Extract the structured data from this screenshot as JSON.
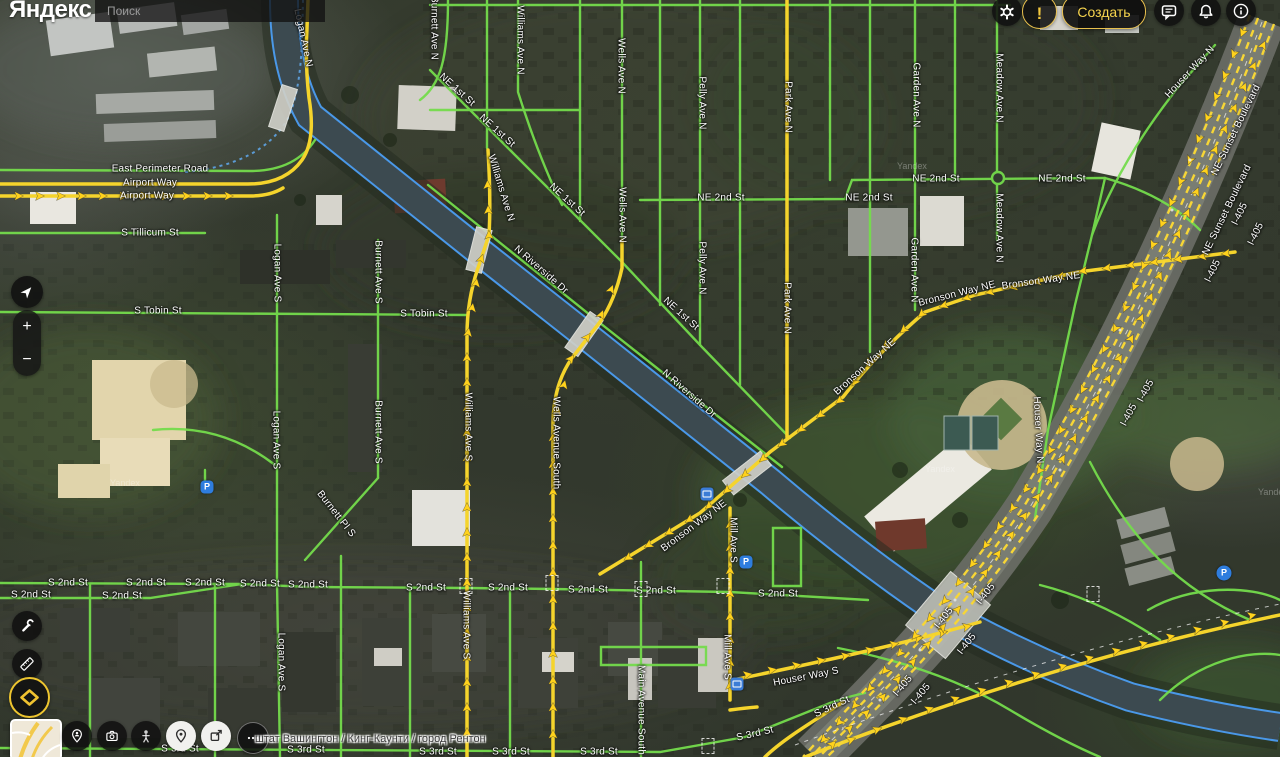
{
  "header": {
    "logo": "Яндекс",
    "search_placeholder": "Поиск",
    "create_label": "Создать",
    "icons": [
      "gear-icon",
      "alert-icon",
      "chat-icon",
      "bell-icon",
      "info-icon"
    ]
  },
  "controls": {
    "zoom_in": "+",
    "zoom_out": "−",
    "icons": [
      "compass-icon",
      "wrench-icon",
      "ruler-icon",
      "layers-diamond-icon",
      "person-pin-icon",
      "camera-icon",
      "pegman-icon",
      "map-pin-icon",
      "external-link-icon",
      "more-icon"
    ]
  },
  "footer": {
    "breadcrumb": "штат Вашингтон / Кинг-Каунти / город Рентон"
  },
  "map": {
    "watermark_text": "Yandex",
    "watermarks": [
      {
        "x": 110,
        "y": 478
      },
      {
        "x": 925,
        "y": 464
      },
      {
        "x": 897,
        "y": 161
      },
      {
        "x": 1258,
        "y": 487
      }
    ],
    "poi": [
      {
        "k": "parking",
        "x": 207,
        "y": 487,
        "label": "P"
      },
      {
        "k": "parking",
        "x": 746,
        "y": 562,
        "label": "P"
      },
      {
        "k": "parking-round",
        "x": 1224,
        "y": 573,
        "label": "P"
      },
      {
        "k": "bus",
        "x": 707,
        "y": 494
      },
      {
        "k": "train",
        "x": 737,
        "y": 684
      }
    ],
    "labels": [
      {
        "t": "East Perimeter Road",
        "x": 160,
        "y": 169,
        "r": 0
      },
      {
        "t": "Airport Way",
        "x": 150,
        "y": 183,
        "r": 0
      },
      {
        "t": "Airport Way",
        "x": 147,
        "y": 196,
        "r": 0
      },
      {
        "t": "S Tillicum St",
        "x": 150,
        "y": 233,
        "r": 0
      },
      {
        "t": "S Tobin St",
        "x": 158,
        "y": 311,
        "r": 0
      },
      {
        "t": "S Tobin St",
        "x": 424,
        "y": 314,
        "r": 0
      },
      {
        "t": "Logan Ave N",
        "x": 303,
        "y": 38,
        "r": 78
      },
      {
        "t": "Logan Ave S",
        "x": 277,
        "y": 273,
        "r": 90
      },
      {
        "t": "Logan Ave S",
        "x": 276,
        "y": 440,
        "r": 90
      },
      {
        "t": "Logan Ave S",
        "x": 281,
        "y": 662,
        "r": 90
      },
      {
        "t": "Burnett Ave N",
        "x": 434,
        "y": 28,
        "r": 90
      },
      {
        "t": "Burnett Ave S",
        "x": 378,
        "y": 272,
        "r": 90
      },
      {
        "t": "Burnett Ave S",
        "x": 378,
        "y": 432,
        "r": 90
      },
      {
        "t": "Burnett Pl S",
        "x": 336,
        "y": 514,
        "r": 52
      },
      {
        "t": "Williams Ave N",
        "x": 520,
        "y": 40,
        "r": 90
      },
      {
        "t": "Williams Ave N",
        "x": 501,
        "y": 188,
        "r": 73
      },
      {
        "t": "Williams Ave S",
        "x": 468,
        "y": 427,
        "r": 90
      },
      {
        "t": "Williams Ave S",
        "x": 466,
        "y": 625,
        "r": 90
      },
      {
        "t": "Wells Ave N",
        "x": 621,
        "y": 66,
        "r": 90
      },
      {
        "t": "Wells Ave N",
        "x": 622,
        "y": 215,
        "r": 90
      },
      {
        "t": "Wells Avenue South",
        "x": 556,
        "y": 443,
        "r": 90
      },
      {
        "t": "Pelly Ave N",
        "x": 702,
        "y": 103,
        "r": 90
      },
      {
        "t": "Pelly Ave N",
        "x": 702,
        "y": 268,
        "r": 90
      },
      {
        "t": "Park Ave N",
        "x": 788,
        "y": 107,
        "r": 90
      },
      {
        "t": "Park Ave N",
        "x": 787,
        "y": 308,
        "r": 90
      },
      {
        "t": "Garden Ave N",
        "x": 916,
        "y": 95,
        "r": 90
      },
      {
        "t": "Garden Ave N",
        "x": 914,
        "y": 270,
        "r": 90
      },
      {
        "t": "Meadow Ave N",
        "x": 999,
        "y": 88,
        "r": 90
      },
      {
        "t": "Meadow Ave N",
        "x": 999,
        "y": 228,
        "r": 90
      },
      {
        "t": "NE 1st St",
        "x": 457,
        "y": 90,
        "r": 42
      },
      {
        "t": "NE 1st St",
        "x": 497,
        "y": 131,
        "r": 42
      },
      {
        "t": "NE 1st St",
        "x": 567,
        "y": 200,
        "r": 42
      },
      {
        "t": "NE 1st St",
        "x": 681,
        "y": 314,
        "r": 42
      },
      {
        "t": "N Riverside Dr",
        "x": 541,
        "y": 270,
        "r": 41
      },
      {
        "t": "N Riverside Dr",
        "x": 689,
        "y": 394,
        "r": 41
      },
      {
        "t": "NE 2nd St",
        "x": 721,
        "y": 198,
        "r": 0
      },
      {
        "t": "NE 2nd St",
        "x": 869,
        "y": 198,
        "r": 0
      },
      {
        "t": "NE 2nd St",
        "x": 936,
        "y": 179,
        "r": 0
      },
      {
        "t": "NE 2nd St",
        "x": 1062,
        "y": 179,
        "r": 0
      },
      {
        "t": "Bronson Way NE",
        "x": 694,
        "y": 526,
        "r": -37
      },
      {
        "t": "Bronson Way NE",
        "x": 865,
        "y": 367,
        "r": -42
      },
      {
        "t": "Bronson Way NE",
        "x": 957,
        "y": 294,
        "r": -14
      },
      {
        "t": "Bronson Way NE",
        "x": 1041,
        "y": 281,
        "r": -8
      },
      {
        "t": "Houser Way N",
        "x": 1038,
        "y": 430,
        "r": 87
      },
      {
        "t": "Houser Way N",
        "x": 1190,
        "y": 72,
        "r": -47
      },
      {
        "t": "Houser Way S",
        "x": 806,
        "y": 677,
        "r": -11
      },
      {
        "t": "NE Sunset Boulevard",
        "x": 1236,
        "y": 130,
        "r": -64
      },
      {
        "t": "NE Sunset Boulevard",
        "x": 1227,
        "y": 210,
        "r": -64
      },
      {
        "t": "I-405",
        "x": 1240,
        "y": 214,
        "r": -64
      },
      {
        "t": "I-405",
        "x": 1213,
        "y": 271,
        "r": -64
      },
      {
        "t": "I-405",
        "x": 1256,
        "y": 234,
        "r": -64
      },
      {
        "t": "I-405",
        "x": 1146,
        "y": 391,
        "r": -62
      },
      {
        "t": "I-405",
        "x": 1129,
        "y": 415,
        "r": -62
      },
      {
        "t": "I-405",
        "x": 986,
        "y": 594,
        "r": -52
      },
      {
        "t": "I-405",
        "x": 944,
        "y": 618,
        "r": -52
      },
      {
        "t": "I-405",
        "x": 967,
        "y": 644,
        "r": -52
      },
      {
        "t": "I-405",
        "x": 903,
        "y": 686,
        "r": -50
      },
      {
        "t": "I-405",
        "x": 921,
        "y": 694,
        "r": -50
      },
      {
        "t": "S 2nd St",
        "x": 68,
        "y": 583,
        "r": 0
      },
      {
        "t": "S 2nd St",
        "x": 146,
        "y": 583,
        "r": 0
      },
      {
        "t": "S 2nd St",
        "x": 205,
        "y": 583,
        "r": 0
      },
      {
        "t": "S 2nd St",
        "x": 260,
        "y": 584,
        "r": 0
      },
      {
        "t": "S 2nd St",
        "x": 308,
        "y": 585,
        "r": 0
      },
      {
        "t": "S 2nd St",
        "x": 31,
        "y": 595,
        "r": 0
      },
      {
        "t": "S 2nd St",
        "x": 122,
        "y": 596,
        "r": 0
      },
      {
        "t": "S 2nd St",
        "x": 426,
        "y": 588,
        "r": 0
      },
      {
        "t": "S 2nd St",
        "x": 508,
        "y": 588,
        "r": 0
      },
      {
        "t": "S 2nd St",
        "x": 588,
        "y": 590,
        "r": 0
      },
      {
        "t": "S 2nd St",
        "x": 656,
        "y": 591,
        "r": 0
      },
      {
        "t": "S 2nd St",
        "x": 778,
        "y": 594,
        "r": 0
      },
      {
        "t": "Main Avenue South",
        "x": 641,
        "y": 710,
        "r": 90
      },
      {
        "t": "Mill Ave S",
        "x": 733,
        "y": 540,
        "r": 90
      },
      {
        "t": "Mill Ave S",
        "x": 727,
        "y": 657,
        "r": 90
      },
      {
        "t": "S 3rd St",
        "x": 180,
        "y": 749,
        "r": 0
      },
      {
        "t": "S 3rd St",
        "x": 306,
        "y": 750,
        "r": 0
      },
      {
        "t": "S 3rd St",
        "x": 438,
        "y": 752,
        "r": 0
      },
      {
        "t": "S 3rd St",
        "x": 511,
        "y": 752,
        "r": 0
      },
      {
        "t": "S 3rd St",
        "x": 599,
        "y": 752,
        "r": 0
      },
      {
        "t": "S 3rd St",
        "x": 755,
        "y": 734,
        "r": -13
      },
      {
        "t": "S 3rd St",
        "x": 832,
        "y": 707,
        "r": -25
      }
    ]
  }
}
